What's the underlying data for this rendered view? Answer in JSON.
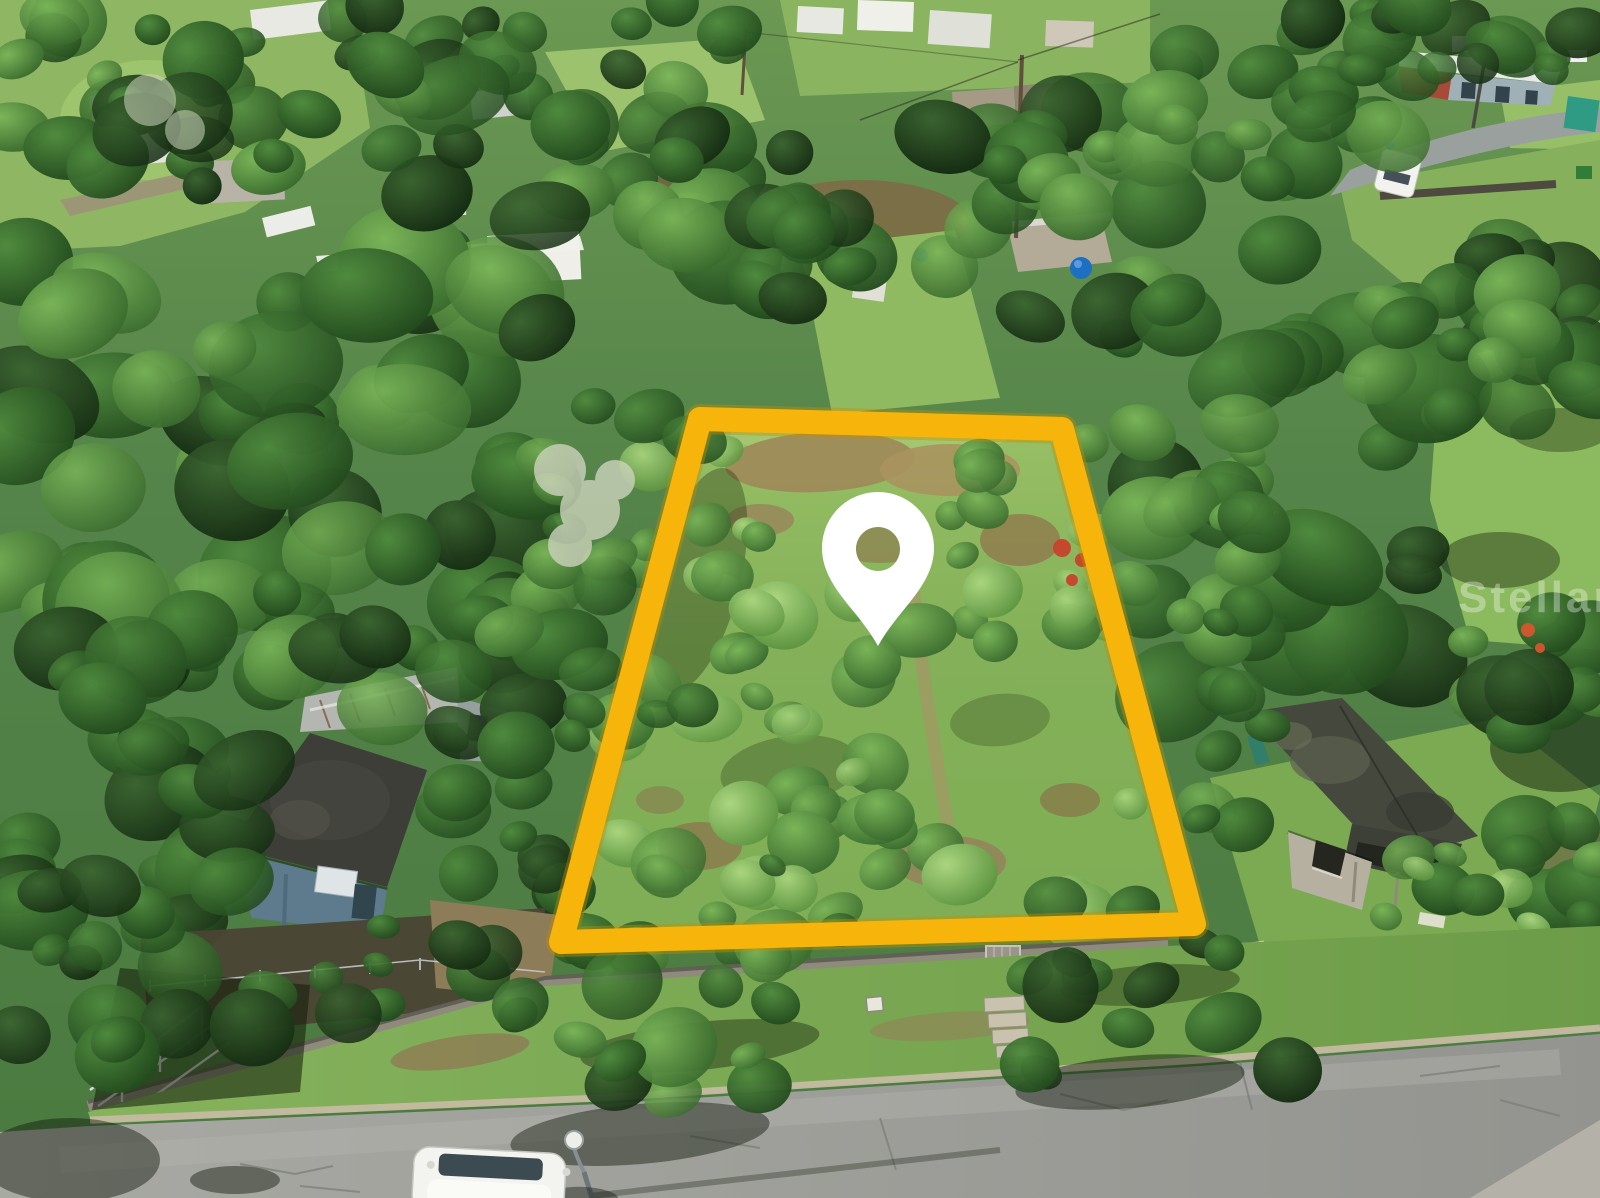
{
  "scene": {
    "watermark": {
      "text": "StellarMLS"
    },
    "overlay": {
      "boundary_color": "#F7B50C",
      "marker_color": "#FFFFFF"
    }
  }
}
